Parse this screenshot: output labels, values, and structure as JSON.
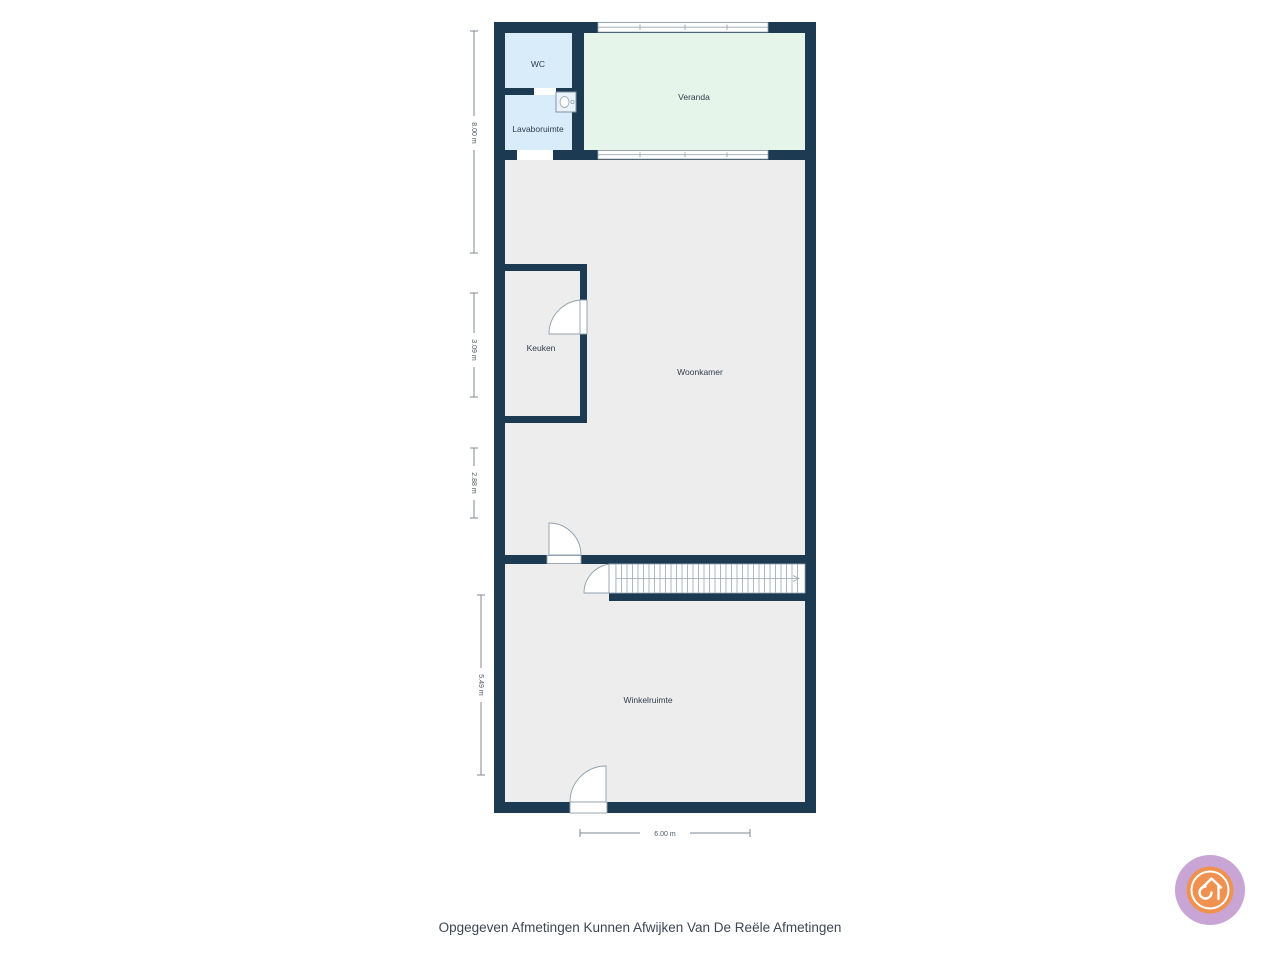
{
  "plan": {
    "rooms": {
      "wc": "WC",
      "lavaboruimte": "Lavaboruimte",
      "veranda": "Veranda",
      "keuken": "Keuken",
      "woonkamer": "Woonkamer",
      "winkelruimte": "Winkelruimte"
    },
    "dimensions": {
      "left_top": "8.00 m",
      "left_keuken": "3.09 m",
      "left_middle": "2.88 m",
      "left_bottom": "5.49 m",
      "bottom_width": "6.00 m"
    },
    "icons": {
      "sink": "washbasin-icon",
      "stairs": "staircase-with-direction-arrow",
      "logo": "house-spiral-icon"
    },
    "colors": {
      "wall": "#1c3a52",
      "wet_room_floor": "#d9ecf9",
      "veranda_floor": "#e6f5e9",
      "room_floor": "#ededed",
      "outline": "#8fa0ae",
      "logo_ring": "#c9a5d6",
      "logo_disc": "#f19150"
    }
  },
  "footer": {
    "disclaimer": "Opgegeven Afmetingen Kunnen Afwijken Van De Reële Afmetingen"
  }
}
